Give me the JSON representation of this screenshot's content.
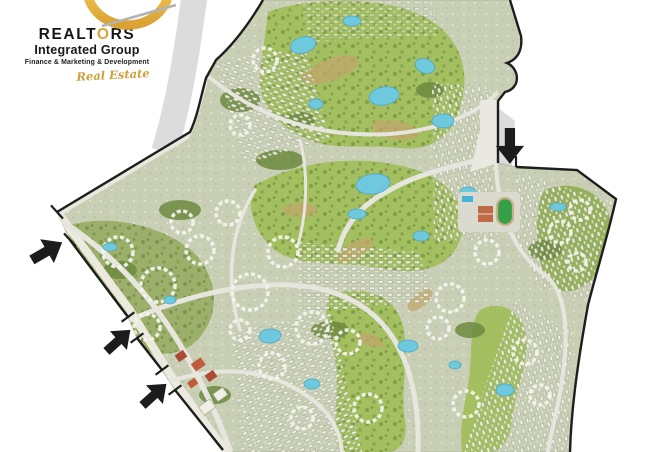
{
  "window": {
    "width": 668,
    "height": 452
  },
  "logo": {
    "brand": "REALTORS",
    "brand_prefix": "REALT",
    "brand_o": "O",
    "brand_suffix": "RS",
    "subtitle": "Integrated Group",
    "tagline": "Finance & Marketing & Development",
    "script": "Real Estate",
    "gold_color": "#d9a43a",
    "text_color": "#161616"
  },
  "map": {
    "description": "Aerial master plan of a golf-course residential community with lakes, winding roads and housing clusters",
    "entrances": [
      {
        "id": "west-entrance",
        "arrow_direction": "northeast"
      },
      {
        "id": "southwest-entrance-1",
        "arrow_direction": "northeast"
      },
      {
        "id": "southwest-entrance-2",
        "arrow_direction": "northeast"
      },
      {
        "id": "north-entrance",
        "arrow_direction": "south"
      }
    ],
    "colors": {
      "boundary": "#1e1e1e",
      "golf_green": "#a3bf60",
      "dark_green": "#6d8a3f",
      "lake": "#6fc9de",
      "residential_base": "#c9cfb5",
      "road": "#e6e6de",
      "sand": "#c2a76d",
      "watermark": "#dcdcdc",
      "sports_field": "#35a047",
      "court": "#c06a45"
    }
  }
}
